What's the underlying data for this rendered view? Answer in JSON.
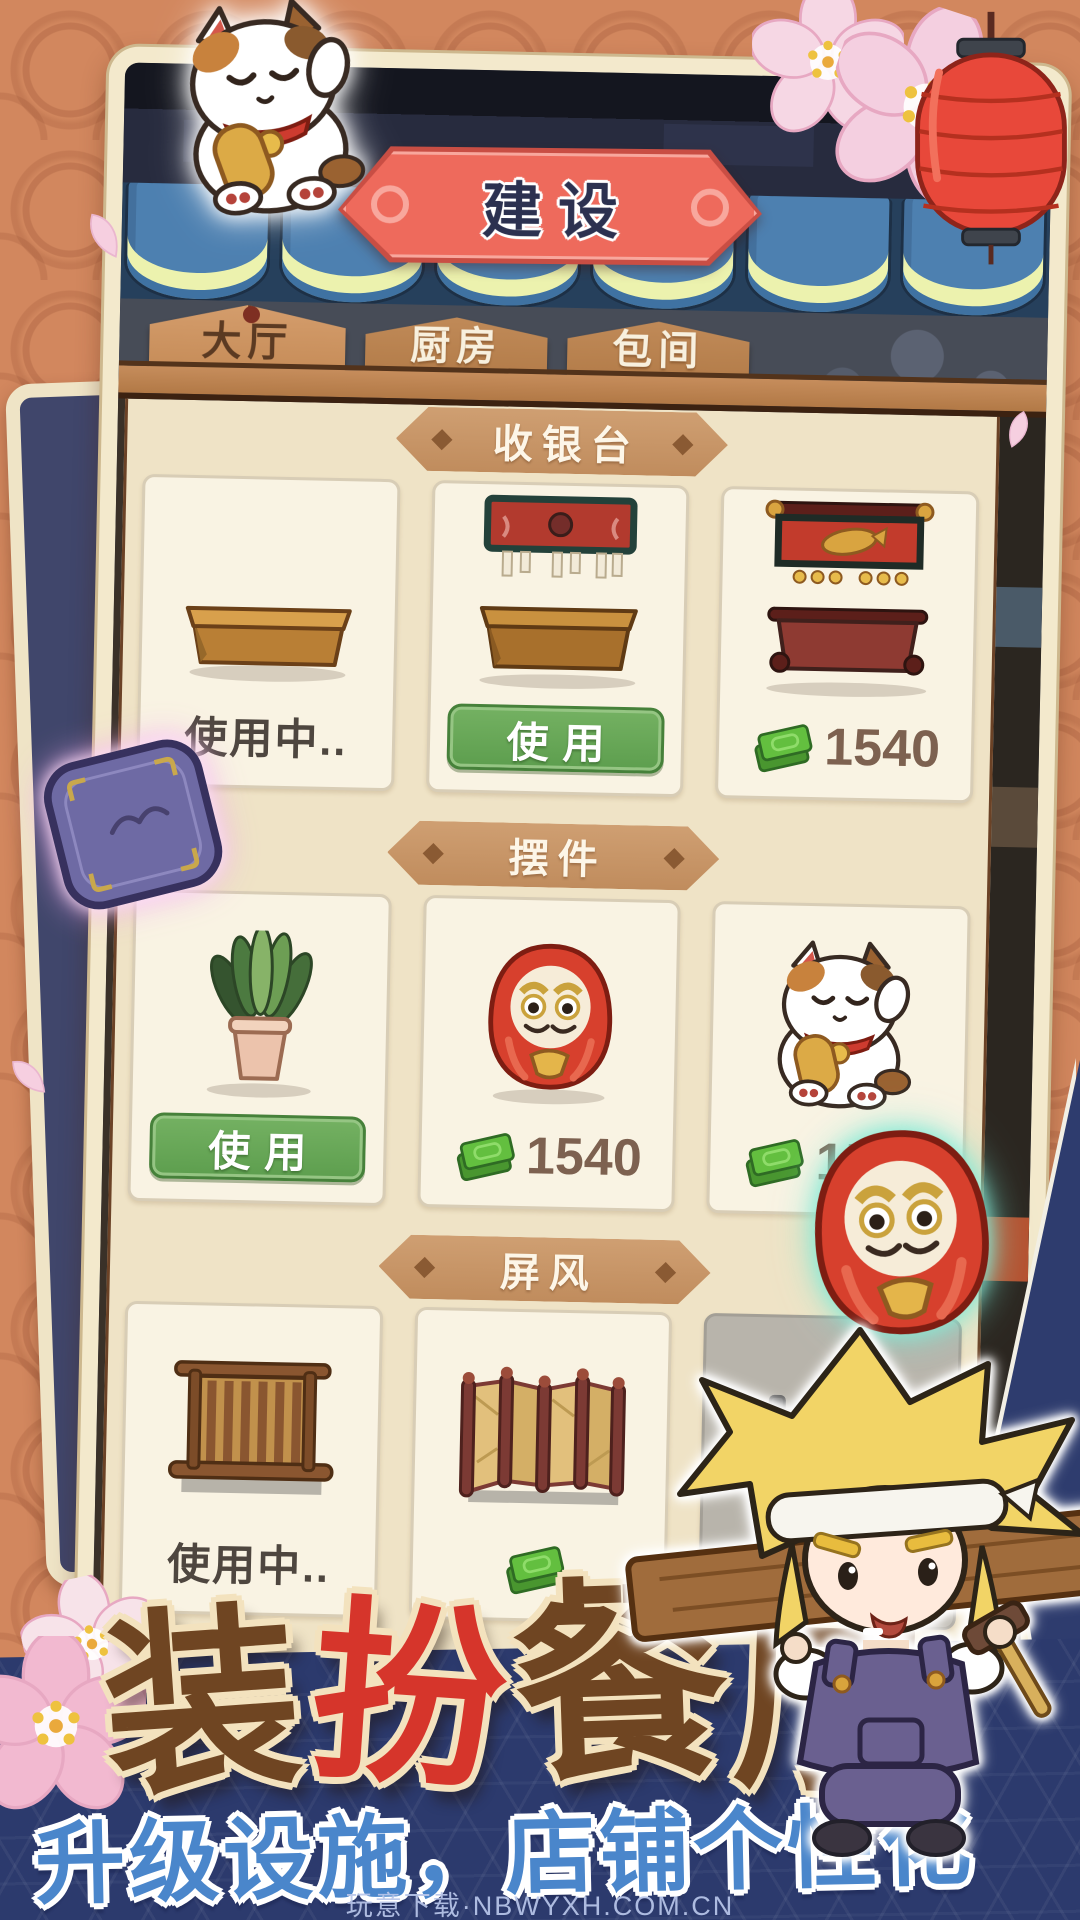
{
  "header": {
    "banner_title": "建设"
  },
  "tabs": [
    {
      "label": "大厅",
      "active": true
    },
    {
      "label": "厨房",
      "active": false
    },
    {
      "label": "包间",
      "active": false
    }
  ],
  "sections": [
    {
      "title": "收银台",
      "items": [
        {
          "name": "basic-counter",
          "status": "使用中.."
        },
        {
          "name": "noren-counter",
          "button": "使用"
        },
        {
          "name": "deluxe-counter",
          "price": "1540"
        }
      ]
    },
    {
      "title": "摆件",
      "items": [
        {
          "name": "potted-plant",
          "button": "使用"
        },
        {
          "name": "daruma-doll",
          "price": "1540"
        },
        {
          "name": "lucky-cat",
          "price": "1540"
        }
      ]
    },
    {
      "title": "屏风",
      "items": [
        {
          "name": "wooden-screen",
          "status": "使用中.."
        },
        {
          "name": "folding-screen",
          "price": ""
        },
        {
          "name": "locked-item",
          "locked": true
        }
      ]
    }
  ],
  "footer": {
    "title_chars": [
      "装",
      "扮",
      "餐",
      "厅"
    ],
    "subtitle": "升级设施，店铺个性化",
    "watermark": "玩意下载·NBWYXH.COM.CN"
  },
  "decorations": [
    "maneki-neko-cat",
    "sakura-blossom",
    "red-lantern",
    "cherry-petal",
    "zabuton-cushion",
    "glowing-daruma",
    "builder-character"
  ],
  "colors": {
    "background_orange": "#d2875e",
    "card_frame_cream": "#f3e9cc",
    "banner_red": "#ee6a5c",
    "awning_blue": "#4d80b0",
    "wood_tan": "#c68d5c",
    "panel_cream": "#efe3c6",
    "button_green": "#5fa254",
    "money_green": "#63bf3f",
    "price_text": "#7d6150",
    "footer_navy": "#2c3a6d",
    "title_brown": "#6f4522",
    "title_red": "#d6352b",
    "subtitle_blue": "#4a86cb"
  }
}
